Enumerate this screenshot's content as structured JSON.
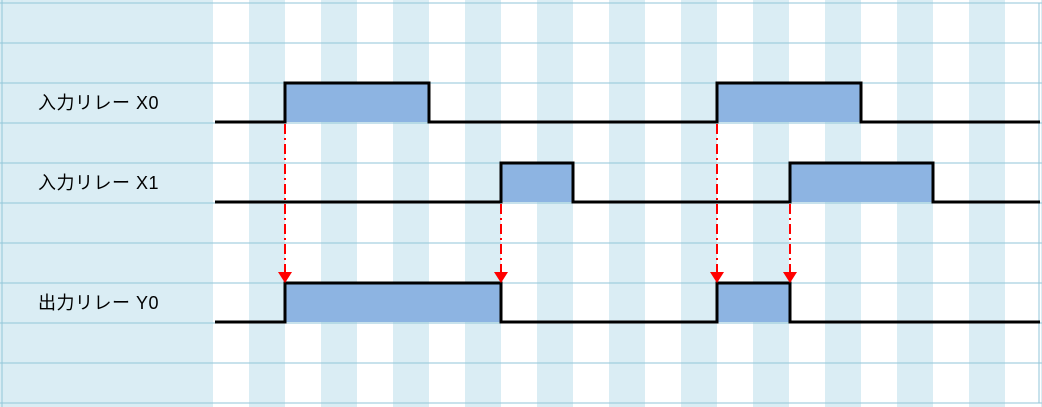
{
  "diagram": {
    "type": "timing-chart",
    "signals": [
      {
        "id": "X0",
        "label": "入力リレー X0",
        "baseline_y": 122,
        "high_y": 83,
        "pulses": [
          [
            285,
            429
          ],
          [
            717,
            861
          ]
        ]
      },
      {
        "id": "X1",
        "label": "入力リレー X1",
        "baseline_y": 202,
        "high_y": 163,
        "pulses": [
          [
            501,
            573
          ],
          [
            790,
            933
          ]
        ]
      },
      {
        "id": "Y0",
        "label": "出力リレー Y0",
        "baseline_y": 322,
        "high_y": 283,
        "pulses": [
          [
            285,
            501
          ],
          [
            717,
            790
          ]
        ]
      }
    ],
    "arrows": [
      {
        "x": 285,
        "from_y": 124,
        "to_y": 283,
        "source": "X0-rise-1",
        "icon": "down-arrow"
      },
      {
        "x": 501,
        "from_y": 204,
        "to_y": 283,
        "source": "X1-rise-1",
        "icon": "down-arrow"
      },
      {
        "x": 717,
        "from_y": 124,
        "to_y": 283,
        "source": "X0-rise-2",
        "icon": "down-arrow"
      },
      {
        "x": 790,
        "from_y": 204,
        "to_y": 283,
        "source": "X1-rise-2",
        "icon": "down-arrow"
      }
    ],
    "colors": {
      "pulse_fill": "#8db4e2",
      "trace": "#000000",
      "arrow": "#ff0000",
      "stripe_blue": "#daedf4",
      "gridline": "#92c6d9",
      "background": "#ffffff"
    },
    "layout": {
      "canvas_w": 1042,
      "canvas_h": 407,
      "x_start": 215,
      "x_end": 1040,
      "stripe_origin": 213,
      "stripe_width": 36,
      "grid_top": 3,
      "row_height": 40,
      "grid_bottom": 403,
      "left_vline_x": 2,
      "right_vline_x": 1039,
      "trace_width": 3,
      "arrow_head_w": 14,
      "arrow_head_h": 11,
      "arrow_dash": "10 4 2 4"
    }
  }
}
